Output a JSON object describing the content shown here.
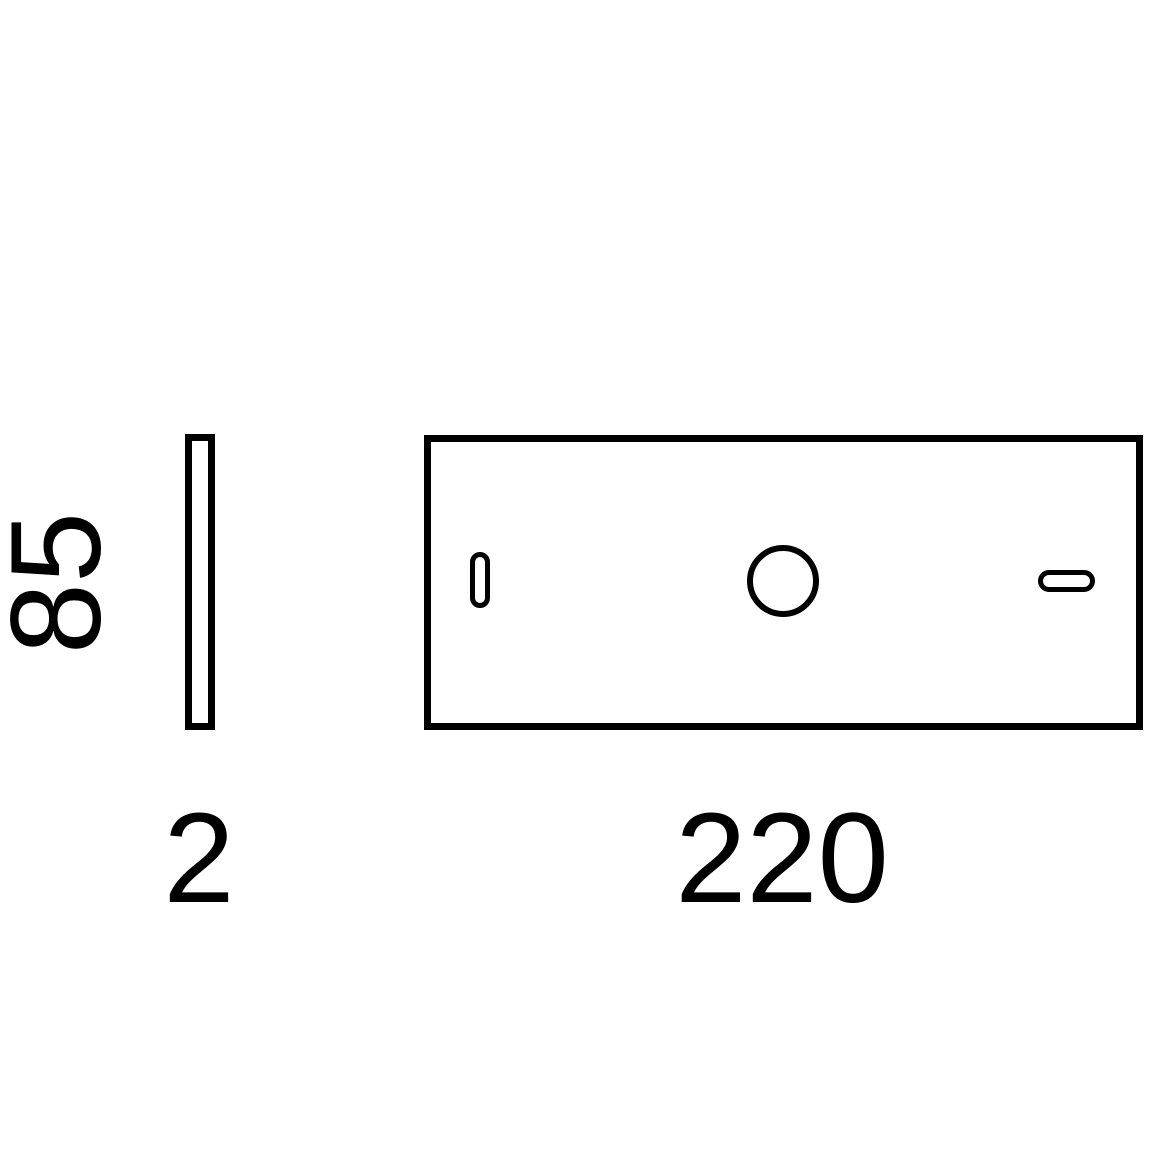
{
  "diagram": {
    "labels": {
      "height": "85",
      "thickness": "2",
      "width": "220"
    },
    "shapes": [
      "side-panel-profile",
      "front-panel",
      "left-vertical-slot",
      "center-hole",
      "right-horizontal-slot"
    ],
    "colors": {
      "line": "#000000",
      "background": "#ffffff"
    }
  }
}
